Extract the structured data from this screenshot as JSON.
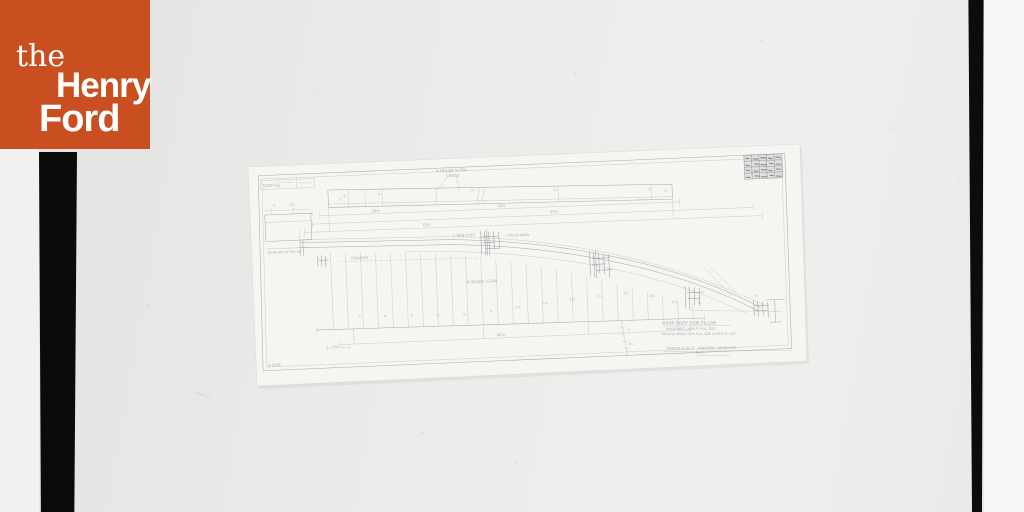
{
  "logo": {
    "word_the": "the",
    "word_henry": "Henry",
    "word_ford": "Ford",
    "bg_color": "#c94e20",
    "text_color": "#ffffff"
  },
  "photo": {
    "backdrop_color": "#eaeae9",
    "film_strip_color": "#0b0b0b",
    "paper_color": "#f6f5f2",
    "pencil_color": "#a7abae"
  },
  "drawing": {
    "stamp": {
      "rows": 4,
      "cols": 5
    },
    "annotations": [
      {
        "text": "4 HOLES ⅜ DIA",
        "x": 184,
        "y": 10,
        "s": 4
      },
      {
        "text": "2 REQD",
        "x": 193,
        "y": 15,
        "s": 3.6
      },
      {
        "text": "SCALE FULL",
        "x": 10,
        "y": 17.5,
        "s": 3
      },
      {
        "text": "⅜",
        "x": 90,
        "y": 31,
        "s": 3.4
      },
      {
        "text": "⅝",
        "x": 124,
        "y": 30.5,
        "s": 3.4
      },
      {
        "text": "¾",
        "x": 218,
        "y": 30,
        "s": 3.4
      },
      {
        "text": "⅝",
        "x": 300,
        "y": 33,
        "s": 3.4
      },
      {
        "text": "⅞",
        "x": 394,
        "y": 36,
        "s": 3.4
      },
      {
        "text": "29⅜",
        "x": 118,
        "y": 47,
        "s": 3.6
      },
      {
        "text": "41⅝",
        "x": 244,
        "y": 47,
        "s": 3.6
      },
      {
        "text": "62⅞",
        "x": 296,
        "y": 55,
        "s": 3.6
      },
      {
        "text": "75¼",
        "x": 168,
        "y": 63,
        "s": 3.6
      },
      {
        "text": "⅞",
        "x": 56,
        "y": 47,
        "s": 3.2
      },
      {
        "text": "⅝",
        "x": 19,
        "y": 37.5,
        "s": 3.2
      },
      {
        "text": "1¼",
        "x": 36,
        "y": 37.5,
        "s": 3.2
      },
      {
        "text": "TEMPLATE OF PILLAR",
        "x": 12,
        "y": 84.5,
        "s": 3.2
      },
      {
        "text": "2 TRIM LINES",
        "x": 198,
        "y": 75,
        "s": 3.4
      },
      {
        "text": "CTR OF PANEL",
        "x": 252,
        "y": 77,
        "s": 3.2
      },
      {
        "text": "STRAIGHT",
        "x": 95,
        "y": 93.5,
        "s": 3.6
      },
      {
        "text": "4 HOLES ¼ DIA",
        "x": 210,
        "y": 122,
        "s": 4
      },
      {
        "text": "⅝",
        "x": 100,
        "y": 152,
        "s": 3.2
      },
      {
        "text": "¾",
        "x": 126,
        "y": 152.5,
        "s": 3.2
      },
      {
        "text": "⅝",
        "x": 152,
        "y": 153,
        "s": 3.2
      },
      {
        "text": "⅞",
        "x": 178,
        "y": 153.5,
        "s": 3.2
      },
      {
        "text": "⅝",
        "x": 205,
        "y": 154,
        "s": 3.2
      },
      {
        "text": "¾",
        "x": 232,
        "y": 152,
        "s": 3.2
      },
      {
        "text": "1⅛",
        "x": 258,
        "y": 149,
        "s": 3.2
      },
      {
        "text": "1⅜",
        "x": 285,
        "y": 146,
        "s": 3.2
      },
      {
        "text": "1⅝",
        "x": 312,
        "y": 143,
        "s": 3.2
      },
      {
        "text": "1⅞",
        "x": 339,
        "y": 141,
        "s": 3.2
      },
      {
        "text": "2⅛",
        "x": 366,
        "y": 139,
        "s": 3.2
      },
      {
        "text": "2⅜",
        "x": 392,
        "y": 143,
        "s": 3.2
      },
      {
        "text": "2⅝",
        "x": 414,
        "y": 150,
        "s": 3.2
      },
      {
        "text": "⅞",
        "x": 440,
        "y": 152,
        "s": 3.2
      },
      {
        "text": "⅝",
        "x": 497,
        "y": 147,
        "s": 3.2
      },
      {
        "text": "48⅞",
        "x": 238,
        "y": 176,
        "s": 3.6
      },
      {
        "text": "1⅝",
        "x": 73,
        "y": 180.5,
        "s": 3.2
      },
      {
        "text": "2",
        "x": 369,
        "y": 176,
        "s": 3
      },
      {
        "text": "1⅝",
        "x": 369,
        "y": 190,
        "s": 3
      },
      {
        "text": "REAR BODY SIDE PILLAR",
        "x": 404,
        "y": 171,
        "s": 4.4,
        "r": 2
      },
      {
        "text": "WOOD PART LAYOUT FULL SIZE",
        "x": 407,
        "y": 176.5,
        "s": 3.2,
        "r": 2
      },
      {
        "text": "MUST BE MADE FROM FULL SIZE LAYOUT AT LOFT",
        "x": 403,
        "y": 181.5,
        "s": 3,
        "r": 2
      },
      {
        "text": "TRACED 5-26-27 · CHECKED · APPROVED",
        "x": 407,
        "y": 196,
        "s": 3.4,
        "r": 2,
        "i": true
      },
      {
        "text": "№ 21",
        "x": 436,
        "y": 201,
        "s": 3,
        "r": 2
      },
      {
        "text": "A-1018",
        "x": 8,
        "y": 197,
        "s": 3.6
      }
    ]
  }
}
